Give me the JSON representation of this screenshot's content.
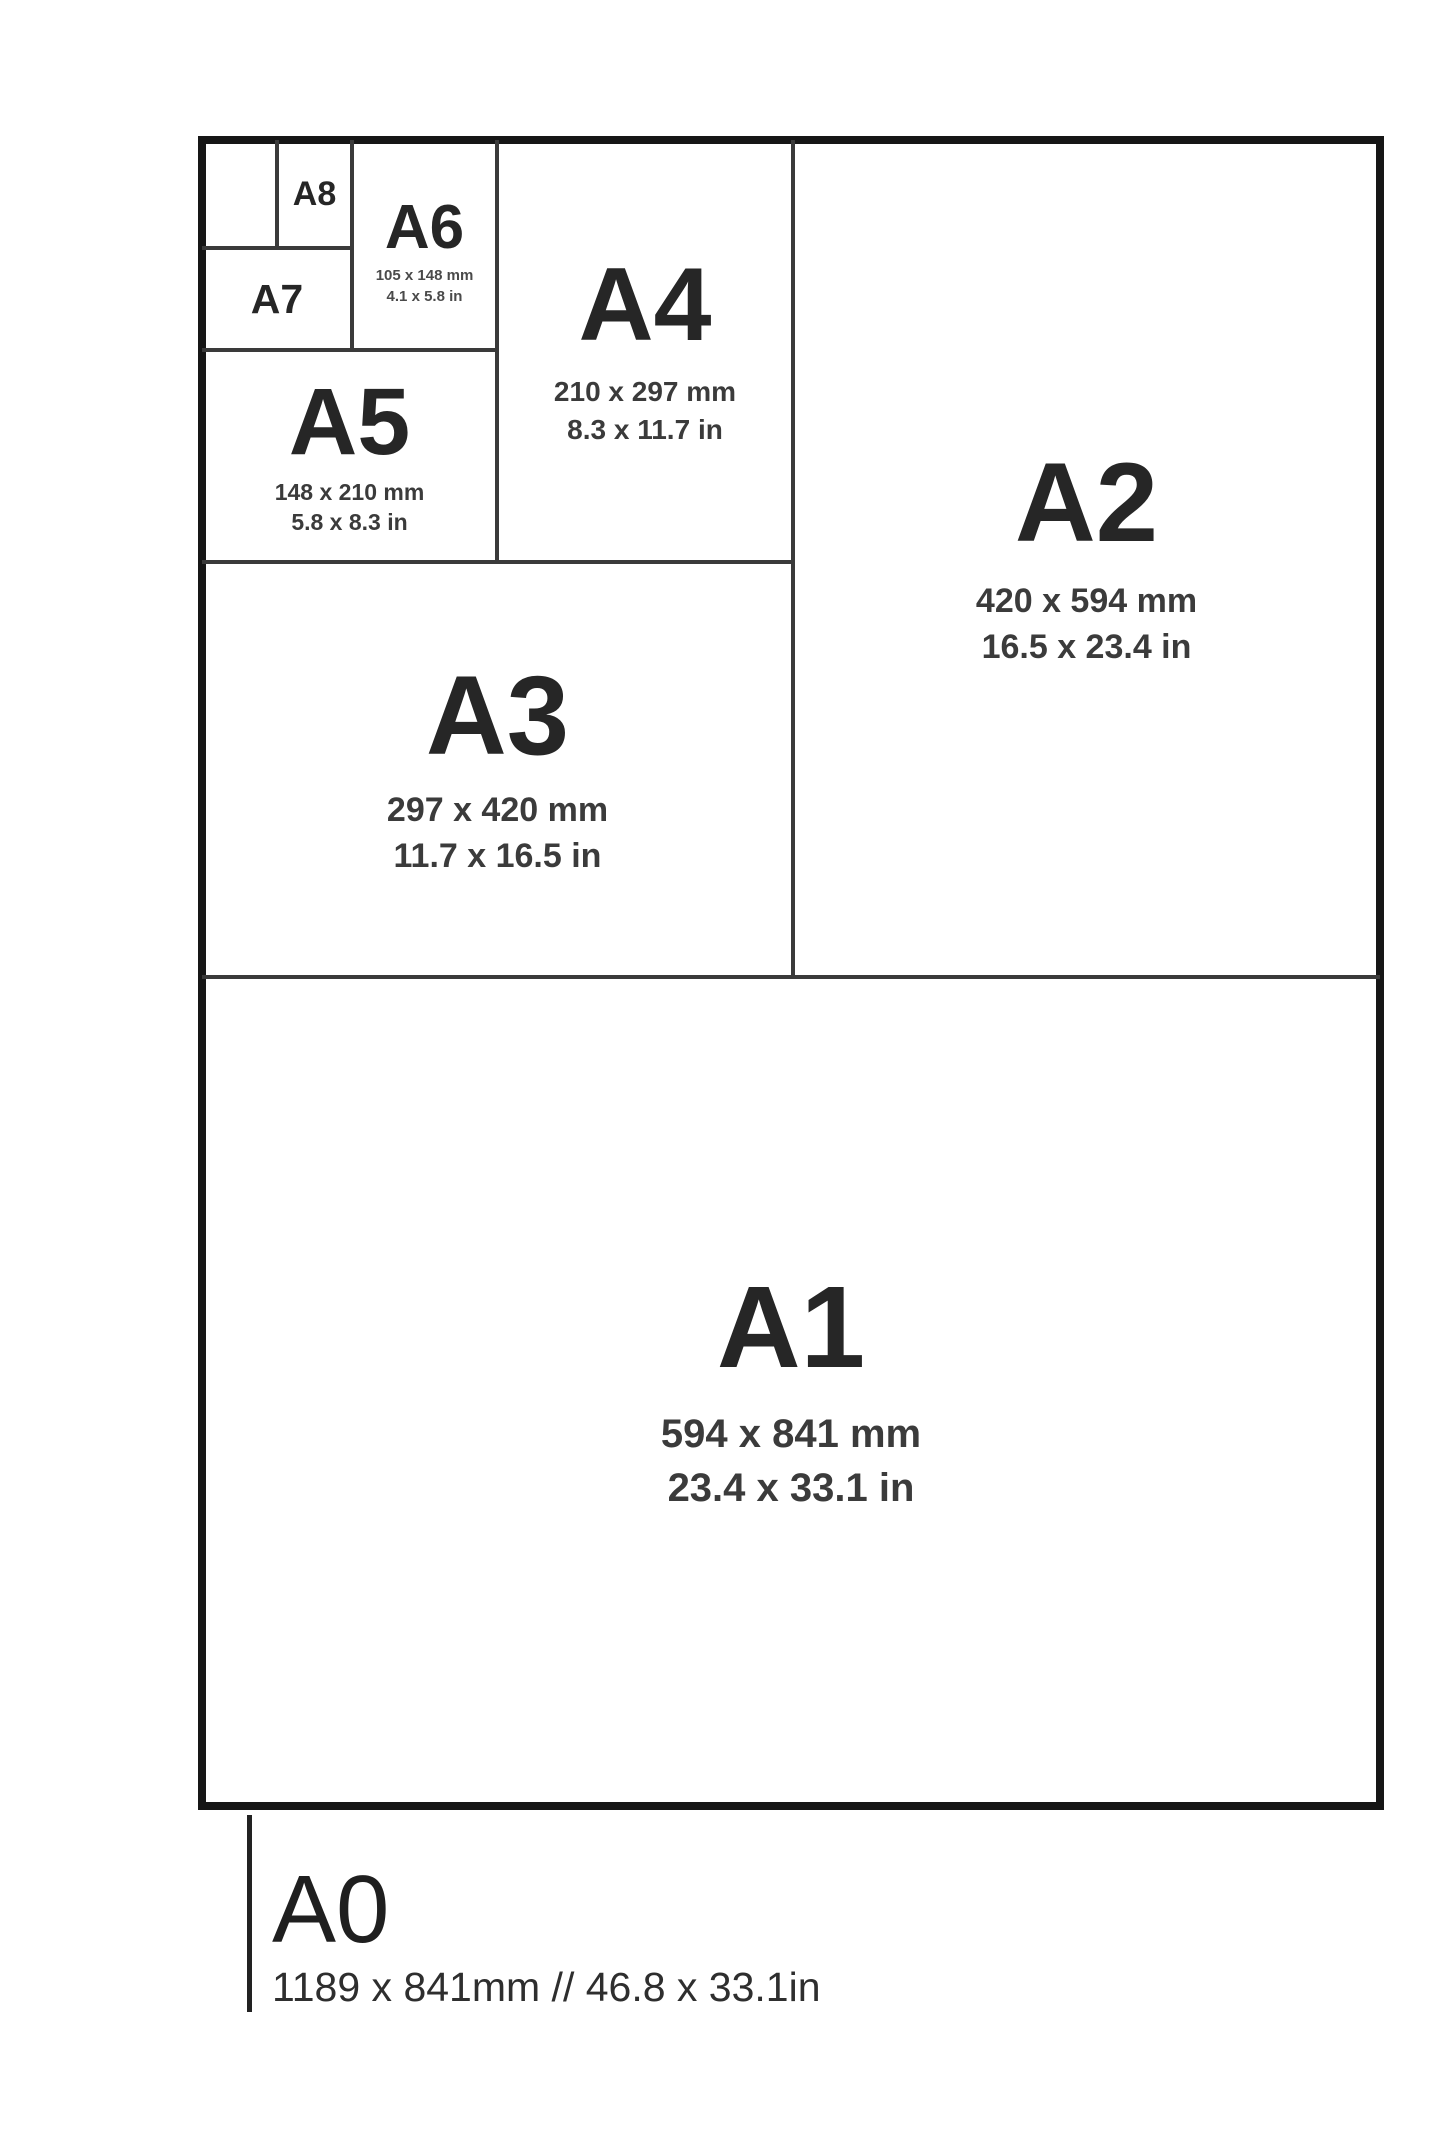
{
  "colors": {
    "background": "#ffffff",
    "outer_border": "#161616",
    "inner_line": "#3a3a3a",
    "label_text": "#262626",
    "dims_text": "#3b3b3b"
  },
  "sizes": {
    "a8": {
      "label": "A8"
    },
    "a7": {
      "label": "A7"
    },
    "a6": {
      "label": "A6",
      "mm": "105 x 148 mm",
      "inch": "4.1 x 5.8 in"
    },
    "a5": {
      "label": "A5",
      "mm": "148 x 210 mm",
      "inch": "5.8 x 8.3 in"
    },
    "a4": {
      "label": "A4",
      "mm": "210 x 297 mm",
      "inch": "8.3 x 11.7 in"
    },
    "a3": {
      "label": "A3",
      "mm": "297 x 420 mm",
      "inch": "11.7 x 16.5 in"
    },
    "a2": {
      "label": "A2",
      "mm": "420 x 594 mm",
      "inch": "16.5 x 23.4 in"
    },
    "a1": {
      "label": "A1",
      "mm": "594 x 841 mm",
      "inch": "23.4 x 33.1 in"
    },
    "a0": {
      "label": "A0",
      "dims": "1189 x 841mm // 46.8 x 33.1in"
    }
  }
}
